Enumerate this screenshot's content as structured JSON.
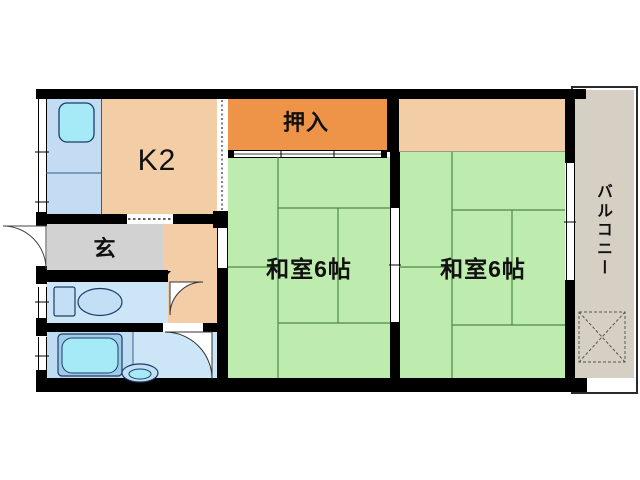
{
  "floorplan": {
    "rooms": [
      {
        "id": "kitchen",
        "label": "K2"
      },
      {
        "id": "oshiire-closet",
        "label": "押入"
      },
      {
        "id": "washitsu-left",
        "label": "和室6帖"
      },
      {
        "id": "washitsu-right",
        "label": "和室6帖"
      },
      {
        "id": "genkan",
        "label": "玄"
      },
      {
        "id": "balcony",
        "label": "バルコニー"
      }
    ],
    "fixtures": [
      "kitchen-sink",
      "toilet",
      "bathtub",
      "washbasin"
    ],
    "colors": {
      "tatami_green": "#BEECAF",
      "tatami_line": "#4F8844",
      "room_peach": "#F3CDA6",
      "closet_orange": "#EE9449",
      "genkan_gray": "#D2D2D2",
      "wet_area_blue": "#CCE6F8",
      "bath_zone_blue": "#BFDCF2",
      "counter_blue": "#C3DCF4",
      "fixture_cyan": "#A5EAF6",
      "balcony_beige": "#D6CFC4",
      "wall_black": "#000000"
    }
  }
}
